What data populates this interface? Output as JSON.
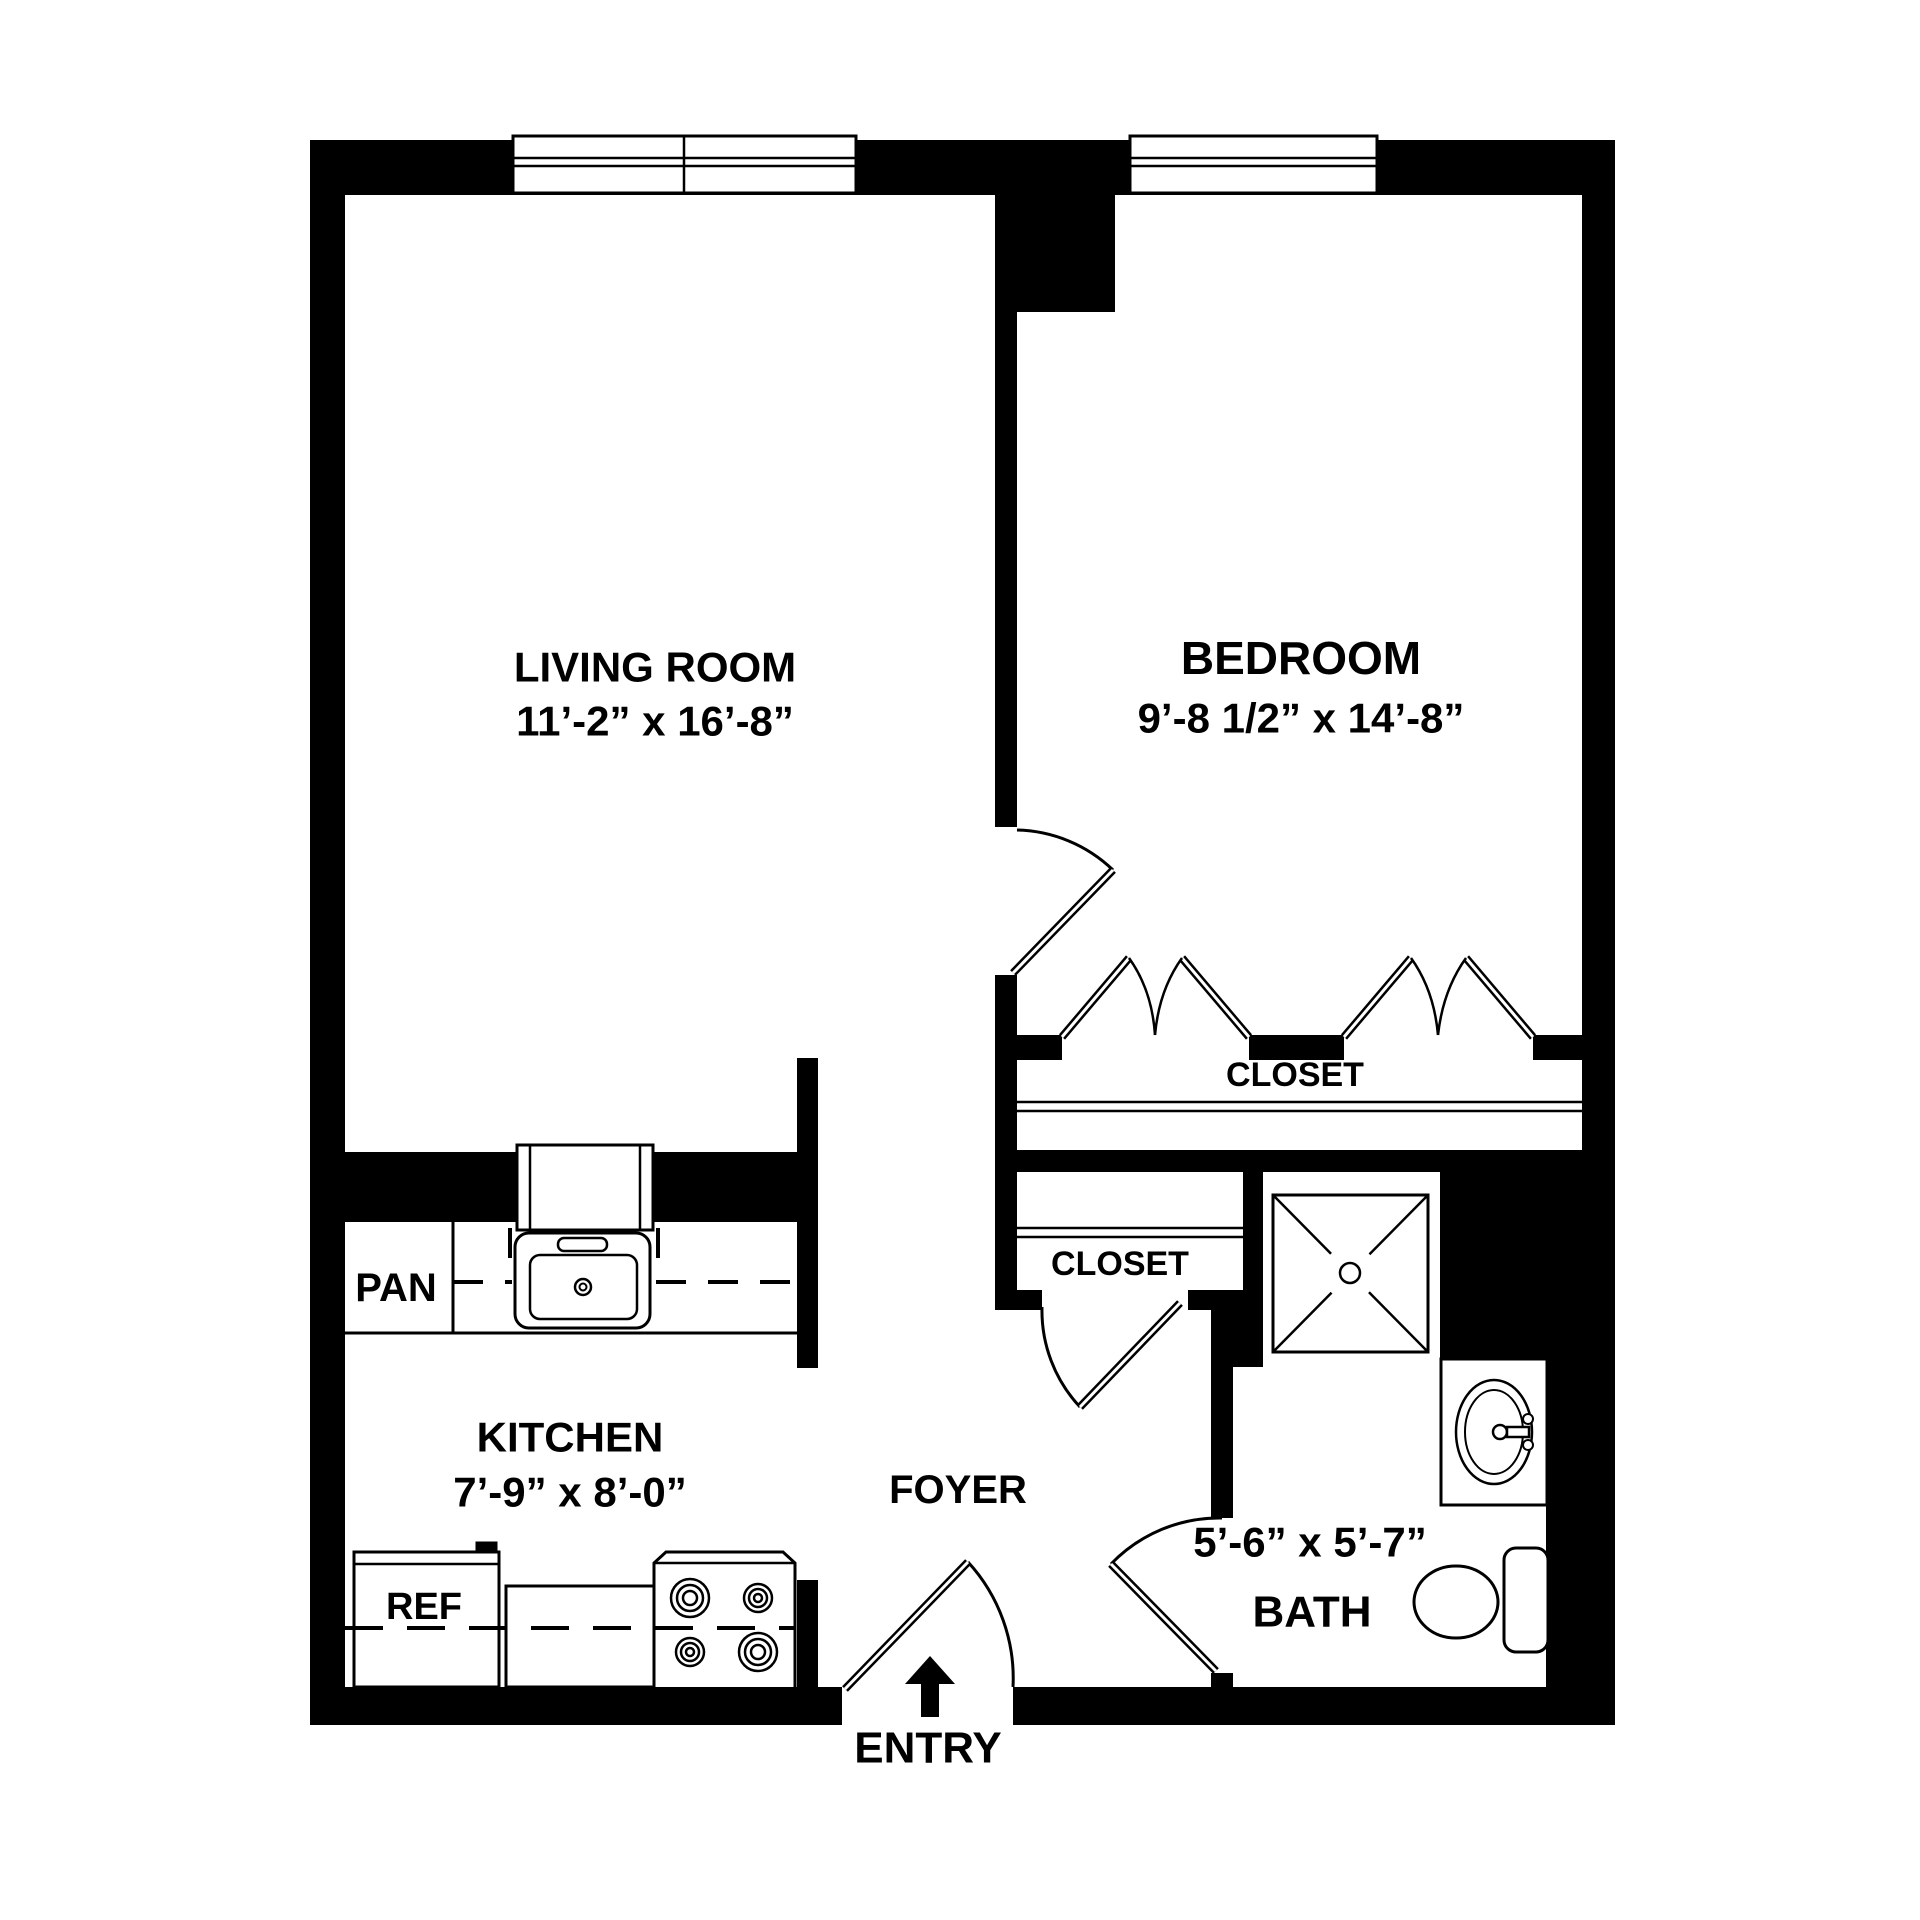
{
  "floor_plan": {
    "colors": {
      "wall": "#000000",
      "background": "#ffffff",
      "line": "#000000"
    },
    "rooms": {
      "living_room": {
        "name": "LIVING ROOM",
        "dimensions": "11’-2” x 16’-8”"
      },
      "bedroom": {
        "name": "BEDROOM",
        "dimensions": "9’-8 1/2” x 14’-8”"
      },
      "kitchen": {
        "name": "KITCHEN",
        "dimensions": "7’-9” x 8’-0”"
      },
      "bath": {
        "name": "BATH",
        "dimensions": "5’-6” x 5’-7”"
      },
      "foyer": {
        "name": "FOYER"
      },
      "bedroom_closet": {
        "name": "CLOSET"
      },
      "foyer_closet": {
        "name": "CLOSET"
      }
    },
    "fixtures": {
      "pantry": "PAN",
      "refrigerator": "REF",
      "entry": "ENTRY"
    }
  }
}
